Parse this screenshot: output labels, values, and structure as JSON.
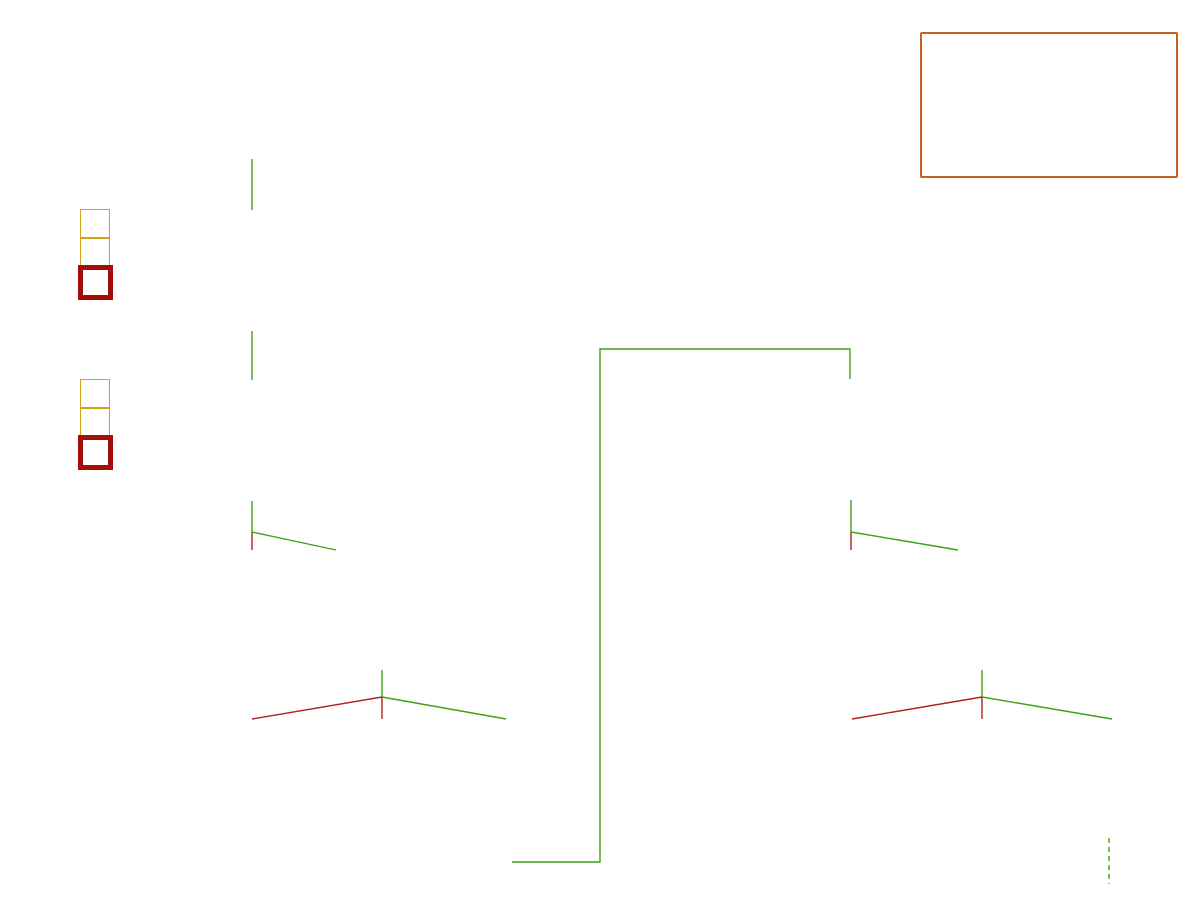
{
  "title": "Late Acceptance",
  "subtitle": "N queens (n = 4, lateAcceptanceSize = 3)",
  "note_box": {
    "text": "n: <= s * m iterations"
  },
  "left_label": {
    "lines": [
      "Late",
      "acceptance",
      "list"
    ]
  },
  "hc_note": "Accepted if HC enabled",
  "board_header": {
    "columns": [
      "A",
      "B",
      "C",
      "D"
    ],
    "rows": [
      "0",
      "1",
      "2",
      "3"
    ]
  },
  "colors": {
    "purple": "#7d3c7d",
    "gold_border": "#d4a017",
    "gold_score": "#cfa00d",
    "black_score": "#141414",
    "red_box": "#a50d0d",
    "red_text": "#cc3333",
    "green_text": "#3fa315",
    "blue_iteration": "#4472c4",
    "orange_note": "#e07a28",
    "box_orange": "#c4611c",
    "board_dark": "#c9c9c3",
    "line_green": "#3ea313",
    "line_red": "#b22222",
    "arrow_green": "#5fc12d",
    "arrow_orange": "#dd9a3e"
  },
  "steps": [
    {
      "label": "Step 0",
      "x": 80,
      "y": 192,
      "cells": [
        "-4",
        ""
      ],
      "late_cell": "",
      "arrows": 0
    },
    {
      "label": "Step 1",
      "x": 80,
      "y": 362,
      "cells": [
        "-2",
        "-4"
      ],
      "late_cell": "",
      "arrows": 1
    },
    {
      "label": "Step 2",
      "x": 80,
      "y": 533,
      "cells": [
        "-3",
        "-2"
      ],
      "late_cell": "-4",
      "arrows": 2
    },
    {
      "label": "Step 3",
      "x": 80,
      "y": 702,
      "cells": [
        "-3",
        "-3"
      ],
      "late_cell": "-2",
      "arrows": 3
    },
    {
      "label": "Step 4",
      "x": 680,
      "y": 362,
      "cells": [
        "-1",
        "-3"
      ],
      "late_cell": "-3",
      "arrows": 3
    },
    {
      "label": "Step 5",
      "x": 680,
      "y": 532,
      "cells": [
        "-3",
        "-1"
      ],
      "late_cell": "-3",
      "arrows": 3
    },
    {
      "label": "Step 6",
      "x": 680,
      "y": 702,
      "cells": [
        "-2",
        "-3"
      ],
      "late_cell": "-1",
      "arrows": 3
    }
  ],
  "boards": [
    {
      "iteration": "0",
      "x": 193,
      "y": 39,
      "header": true,
      "queens": [
        "C1",
        "B2",
        "A3",
        "D3"
      ],
      "score": "-4",
      "score_color": "gold",
      "acceptance": "",
      "acceptance_color": "green",
      "move": null
    },
    {
      "iteration": "1",
      "x": 192,
      "y": 210,
      "queens": [
        "A0",
        "C1",
        "B2",
        "D3"
      ],
      "score": "-2",
      "score_color": "gold",
      "acceptance": "≥ any",
      "acceptance_color": "green",
      "move": {
        "from": "A3",
        "to": "A0",
        "color": "green"
      }
    },
    {
      "iteration": "2",
      "x": 192,
      "y": 380,
      "queens": [
        "A0",
        "B2",
        "C3",
        "D3"
      ],
      "score": "-3",
      "score_color": "gold",
      "acceptance": "≥ any",
      "acceptance_color": "green",
      "move": {
        "from": "C1",
        "to": "C3",
        "color": "green"
      }
    },
    {
      "iteration": "3",
      "x": 190,
      "y": 550,
      "queens": [
        "B2",
        "A3",
        "C3",
        "D3"
      ],
      "score": "-5",
      "score_color": "black",
      "acceptance": "< -4",
      "acceptance_color": "red",
      "move": {
        "from": "A0",
        "to": "A3",
        "color": "orange"
      }
    },
    {
      "iteration": "4",
      "x": 322,
      "y": 550,
      "queens": [
        "A0",
        "B0",
        "C3",
        "D3"
      ],
      "score": "-3",
      "score_color": "gold",
      "acceptance": "≥ -4",
      "acceptance_color": "green",
      "move": {
        "from": "B2",
        "to": "B0",
        "color": "green"
      }
    },
    {
      "iteration": "5",
      "x": 190,
      "y": 720,
      "queens": [
        "B0",
        "A1",
        "C3",
        "D3"
      ],
      "score": "-3",
      "score_color": "black",
      "acceptance": "< -2",
      "acceptance_color": "red",
      "hc_note": true,
      "move": {
        "from": "A0",
        "to": "A1",
        "color": "orange"
      }
    },
    {
      "iteration": "6",
      "x": 322,
      "y": 720,
      "queens": [
        "A0",
        "B0",
        "C2",
        "D3"
      ],
      "score": "-4",
      "score_color": "black",
      "acceptance": "< -2",
      "acceptance_color": "red",
      "move": {
        "from": "C3",
        "to": "C2",
        "color": "orange"
      }
    },
    {
      "iteration": "7",
      "x": 450,
      "y": 720,
      "queens": [
        "A0",
        "B0",
        "D1",
        "C3"
      ],
      "score": "-1",
      "score_color": "gold",
      "acceptance": "≥ -2",
      "acceptance_color": "green",
      "move": {
        "from": "D3",
        "to": "D1",
        "color": "green"
      }
    },
    {
      "iteration": "8",
      "x": 791,
      "y": 380,
      "queens": [
        "A0",
        "B0",
        "D1",
        "C2"
      ],
      "score": "-3",
      "score_color": "gold",
      "acceptance": "≥ -3",
      "acceptance_color": "green",
      "move": {
        "from": "C3",
        "to": "C2",
        "color": "green"
      }
    },
    {
      "iteration": "9",
      "x": 790,
      "y": 550,
      "queens": [
        "A0",
        "B0",
        "C0",
        "D1"
      ],
      "score": "-4",
      "score_color": "black",
      "acceptance": "< -3",
      "acceptance_color": "red",
      "move": {
        "from": "C2",
        "to": "C0",
        "color": "orange"
      }
    },
    {
      "iteration": "10",
      "x": 922,
      "y": 550,
      "queens": [
        "B0",
        "D1",
        "A2",
        "C2"
      ],
      "score": "-2",
      "score_color": "gold",
      "acceptance": "≥ -3",
      "acceptance_color": "green",
      "move": {
        "from": "A0",
        "to": "A2",
        "color": "green"
      }
    },
    {
      "iteration": "11",
      "x": 790,
      "y": 720,
      "queens": [
        "B0",
        "A2",
        "C2",
        "D3"
      ],
      "score": "-2",
      "score_color": "black",
      "acceptance": "< -1",
      "acceptance_color": "red",
      "hc_note": true,
      "move": {
        "from": "D1",
        "to": "D3",
        "color": "orange"
      }
    },
    {
      "iteration": "12",
      "x": 922,
      "y": 720,
      "queens": [
        "B1",
        "D1",
        "A2",
        "C2"
      ],
      "score": "-5",
      "score_color": "black",
      "acceptance": "< -1",
      "acceptance_color": "red",
      "move": {
        "from": "B0",
        "to": "B1",
        "color": "orange"
      }
    },
    {
      "iteration": "13",
      "x": 1052,
      "y": 720,
      "queens": [
        "B0",
        "D1",
        "A2",
        "C3"
      ],
      "score": "0",
      "score_color": "gold",
      "acceptance": "≥ -1",
      "acceptance_color": "green",
      "move": {
        "from": "C2",
        "to": "C3",
        "color": "green"
      }
    }
  ],
  "connectors": [
    {
      "color": "green",
      "points": [
        [
          252,
          159
        ],
        [
          252,
          210
        ]
      ]
    },
    {
      "color": "green",
      "points": [
        [
          252,
          331
        ],
        [
          252,
          380
        ]
      ]
    },
    {
      "color": "green",
      "points": [
        [
          252,
          501
        ],
        [
          252,
          532
        ]
      ]
    },
    {
      "color": "red",
      "points": [
        [
          252,
          532
        ],
        [
          252,
          550
        ]
      ]
    },
    {
      "color": "green",
      "points": [
        [
          252,
          532
        ],
        [
          336,
          550
        ]
      ]
    },
    {
      "color": "green",
      "points": [
        [
          382,
          670
        ],
        [
          382,
          697
        ]
      ]
    },
    {
      "color": "red",
      "points": [
        [
          382,
          697
        ],
        [
          252,
          719
        ]
      ]
    },
    {
      "color": "red",
      "points": [
        [
          382,
          697
        ],
        [
          382,
          719
        ]
      ]
    },
    {
      "color": "green",
      "points": [
        [
          382,
          697
        ],
        [
          506,
          719
        ]
      ]
    },
    {
      "color": "green",
      "points": [
        [
          512,
          862
        ],
        [
          600,
          862
        ],
        [
          600,
          349
        ],
        [
          850,
          349
        ],
        [
          850,
          379
        ]
      ]
    },
    {
      "color": "green",
      "points": [
        [
          851,
          500
        ],
        [
          851,
          532
        ]
      ]
    },
    {
      "color": "red",
      "points": [
        [
          851,
          532
        ],
        [
          851,
          550
        ]
      ]
    },
    {
      "color": "green",
      "points": [
        [
          851,
          532
        ],
        [
          958,
          550
        ]
      ]
    },
    {
      "color": "green",
      "points": [
        [
          982,
          670
        ],
        [
          982,
          697
        ]
      ]
    },
    {
      "color": "red",
      "points": [
        [
          982,
          697
        ],
        [
          852,
          719
        ]
      ]
    },
    {
      "color": "red",
      "points": [
        [
          982,
          697
        ],
        [
          982,
          719
        ]
      ]
    },
    {
      "color": "green",
      "points": [
        [
          982,
          697
        ],
        [
          1112,
          719
        ]
      ]
    },
    {
      "color": "green",
      "dashed": true,
      "points": [
        [
          1109,
          838
        ],
        [
          1109,
          884
        ]
      ]
    }
  ]
}
